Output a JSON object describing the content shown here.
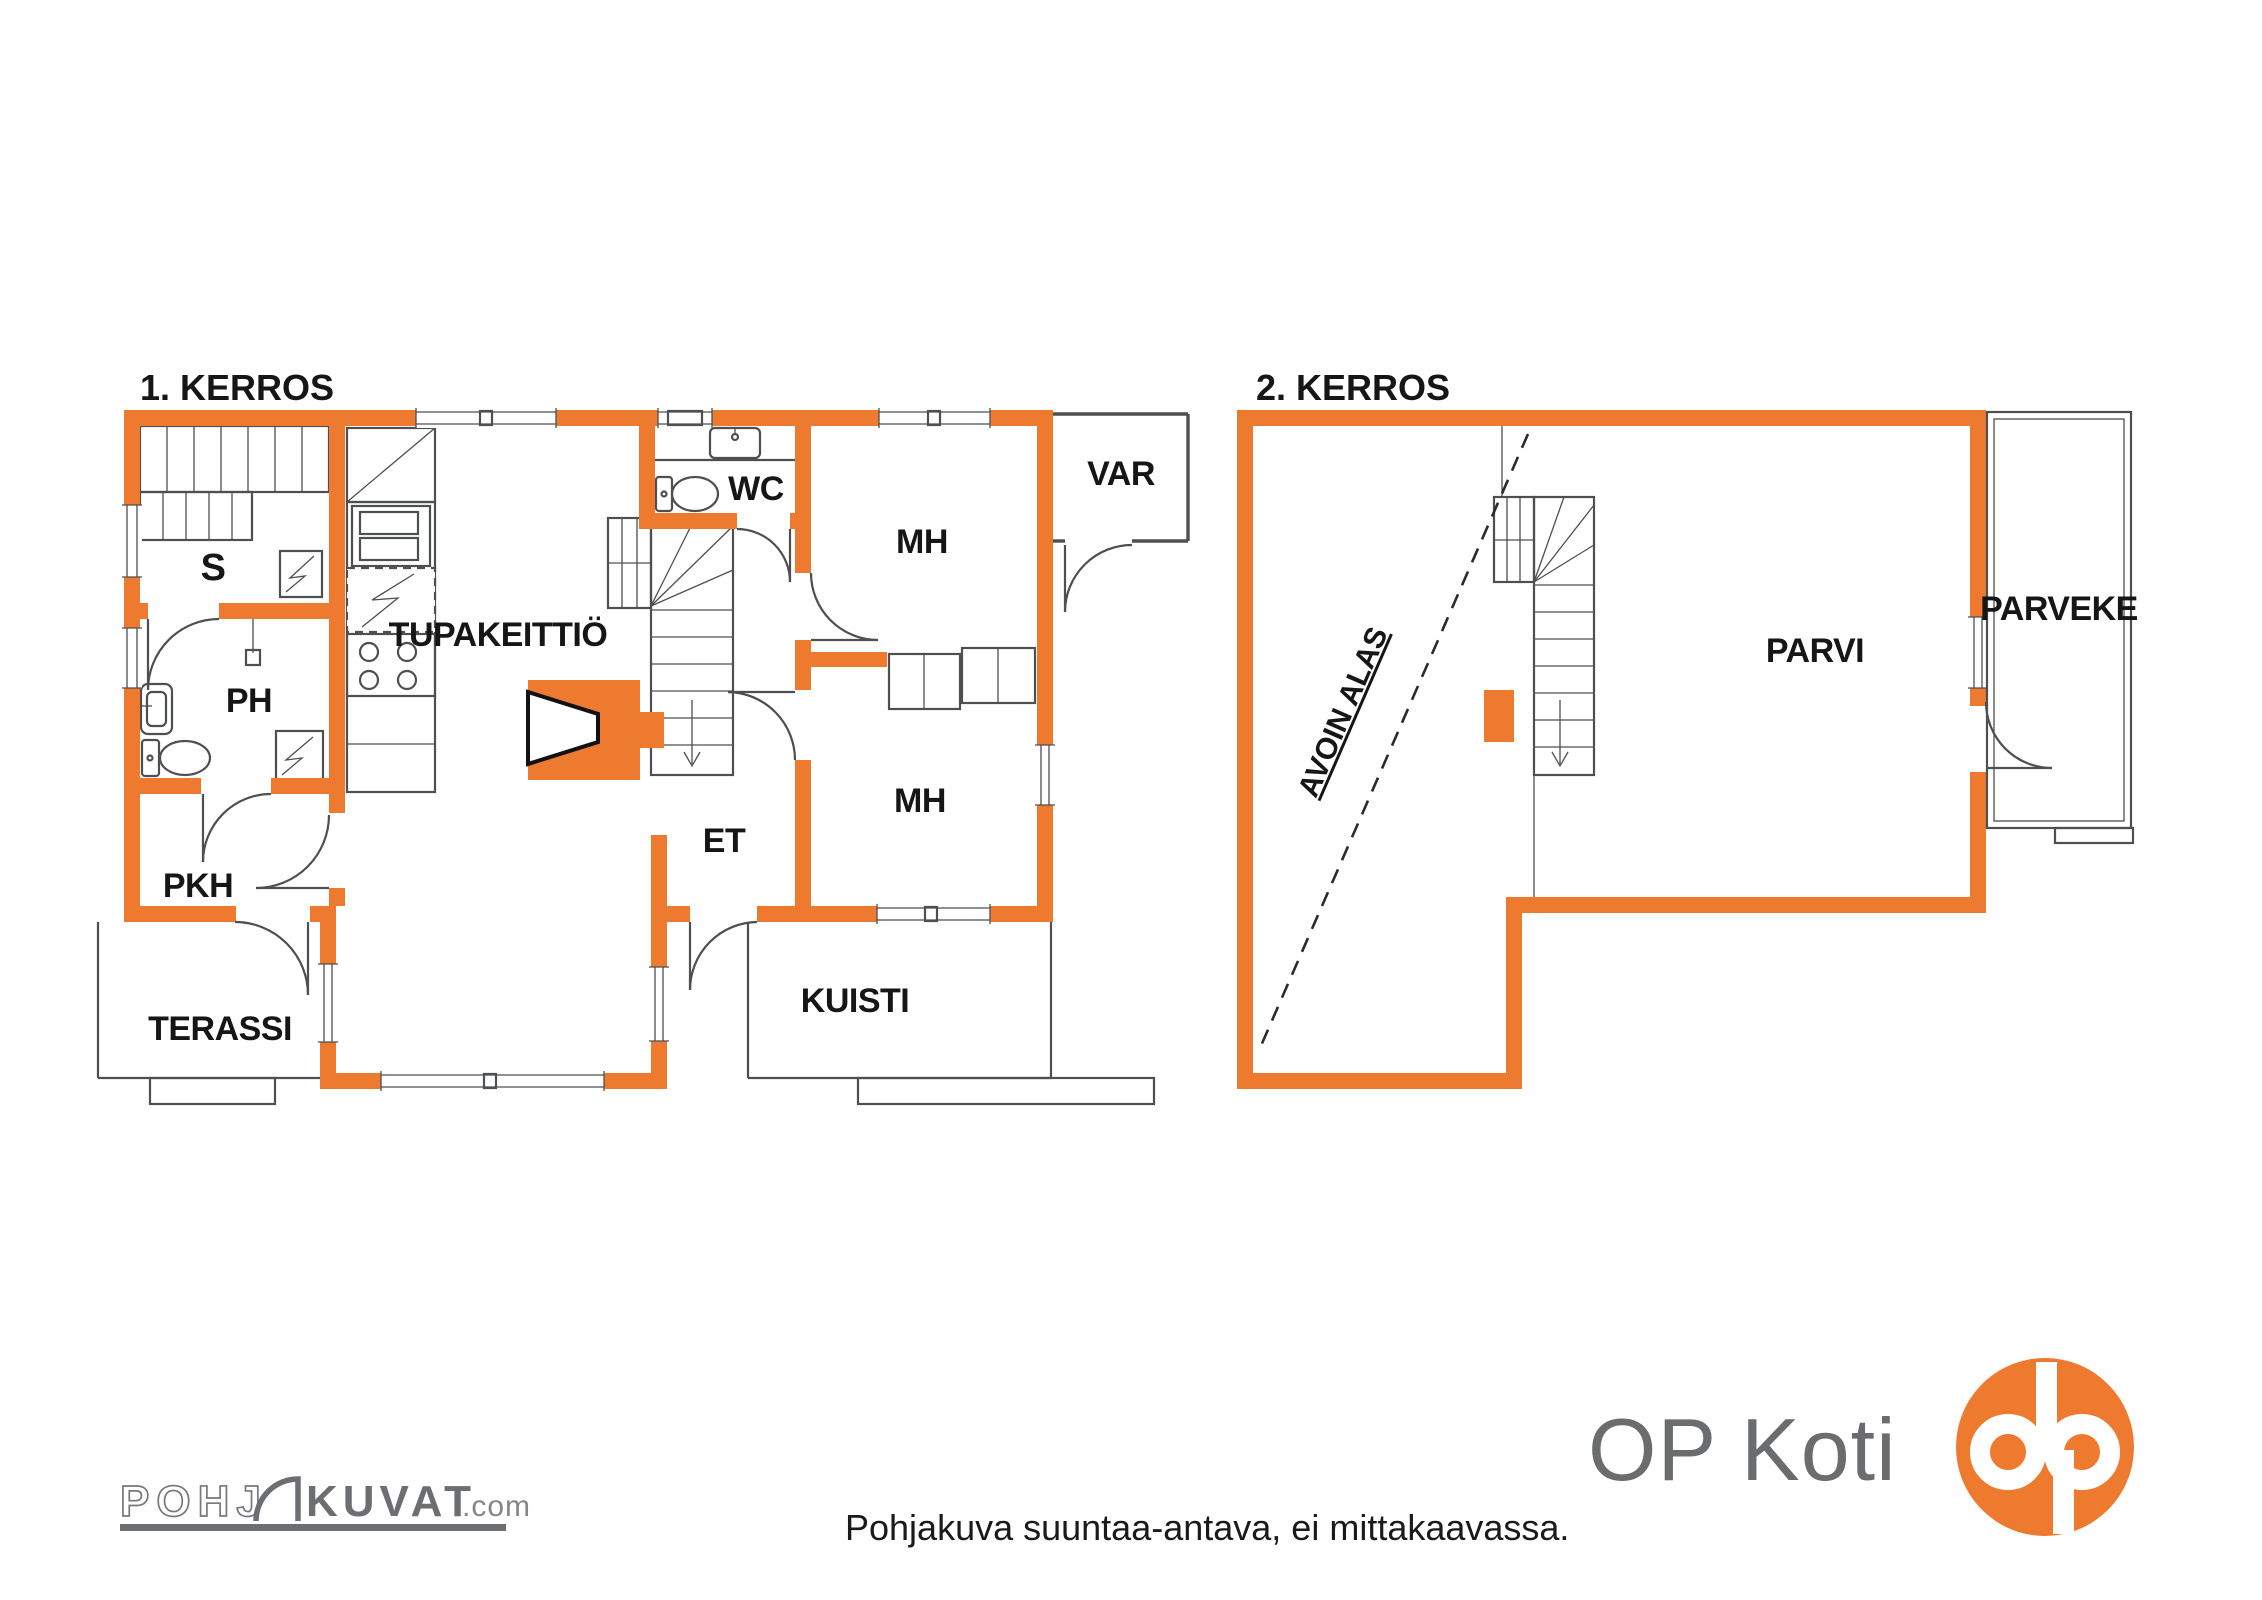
{
  "colors": {
    "wall_orange": "#ED7A2F",
    "line_gray": "#4e4f51",
    "text_black": "#161616",
    "logo_gray": "#6d6e71",
    "op_circle_orange": "#ED7A2F",
    "background": "#ffffff"
  },
  "floor1": {
    "title": "1. KERROS",
    "rooms": {
      "s": "S",
      "tupakeittio": "TUPAKEITTIÖ",
      "wc": "WC",
      "mh_top": "MH",
      "mh_bottom": "MH",
      "ph": "PH",
      "pkh": "PKH",
      "et": "ET",
      "terassi": "TERASSI",
      "kuisti": "KUISTI",
      "var": "VAR"
    }
  },
  "floor2": {
    "title": "2. KERROS",
    "rooms": {
      "parvi": "PARVI",
      "parveke": "PARVEKE",
      "avoin_alas": "AVOIN ALAS"
    }
  },
  "footer": {
    "disclaimer": "Pohjakuva suuntaa-antava, ei mittakaavassa.",
    "op_koti": "OP Koti",
    "logo": {
      "pohj": "POHJ",
      "kuvat": "KUVAT",
      "com": ".com"
    }
  }
}
